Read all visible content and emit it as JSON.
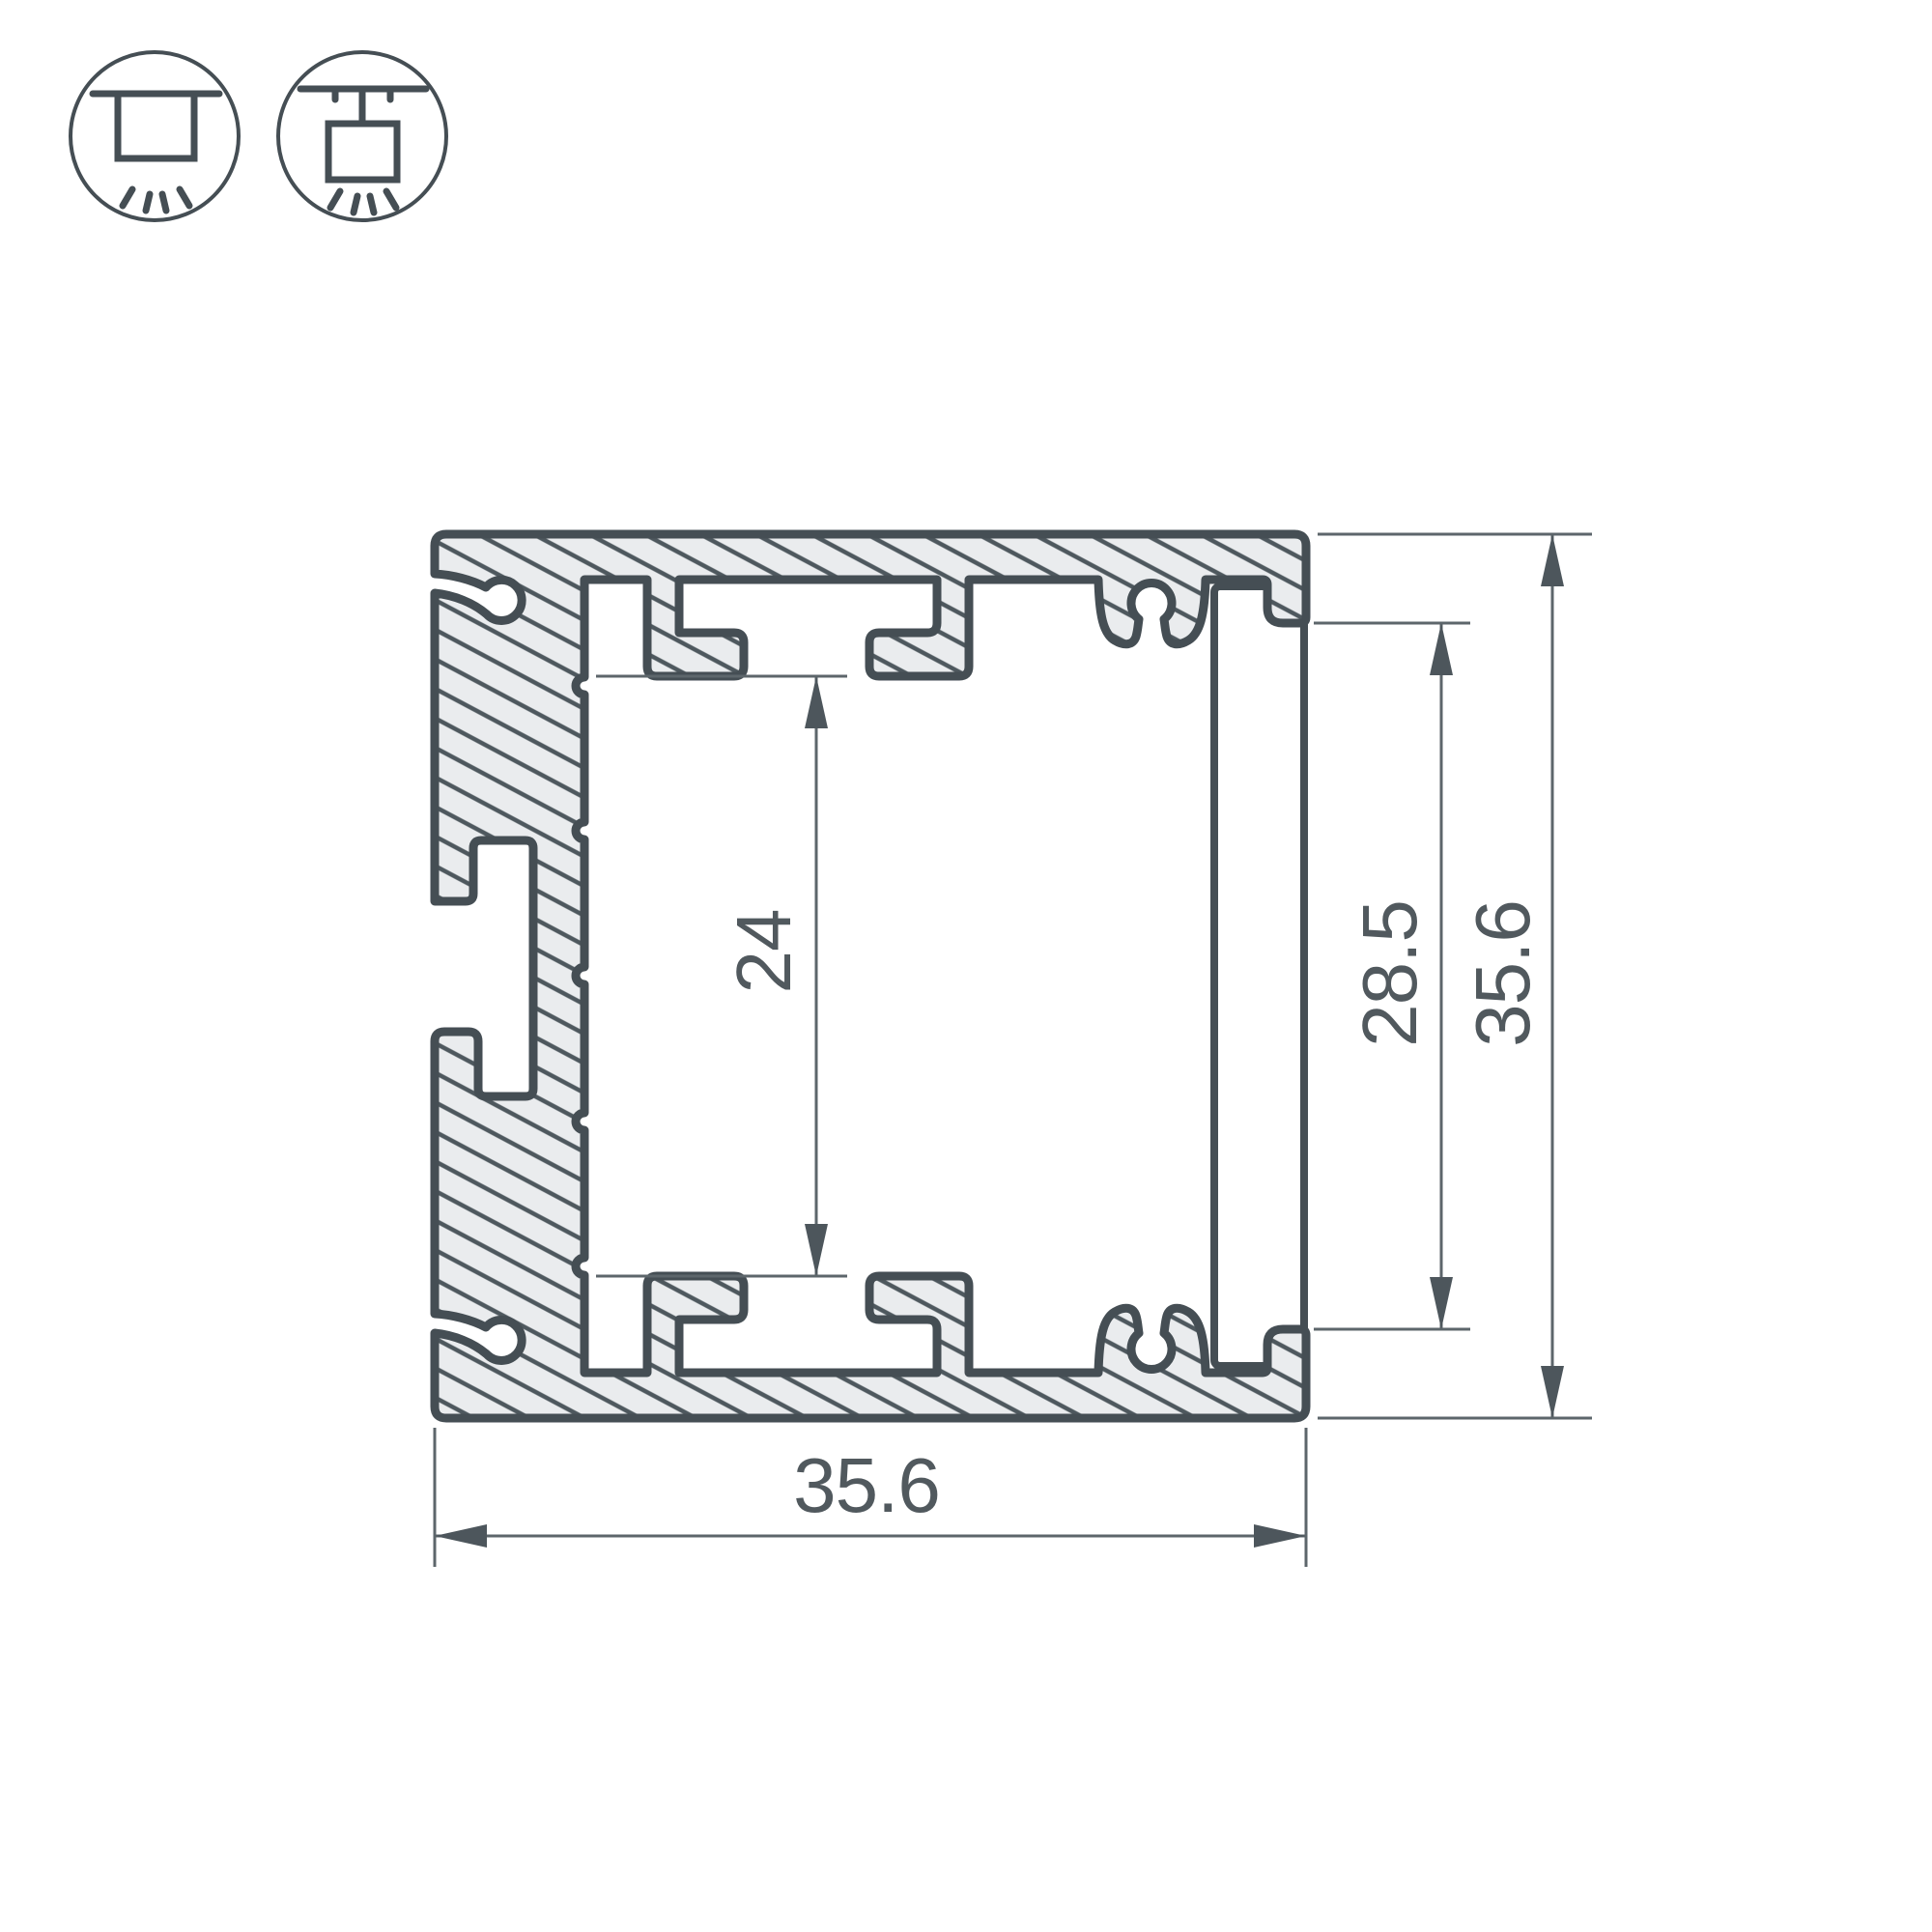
{
  "drawing": {
    "type": "aluminium-led-profile-cross-section",
    "dimensions": {
      "outer_width": "35.6",
      "outer_height": "35.6",
      "opening_height": "28.5",
      "cavity_height": "24"
    },
    "icons": [
      {
        "name": "surface-mount-luminaire-icon"
      },
      {
        "name": "suspended-luminaire-icon"
      }
    ],
    "colors": {
      "outline": "#454e54",
      "hatch_line": "#4e585e",
      "profile_fill": "#eaecee",
      "dimension_line": "#5d666b",
      "text": "#51595e",
      "background": "#ffffff"
    }
  }
}
